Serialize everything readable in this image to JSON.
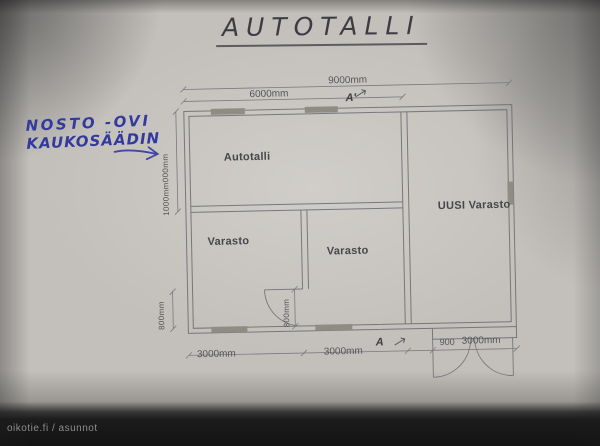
{
  "photo": {
    "title": "AUTOTALLI",
    "watermark": "oikotie.fi / asunnot"
  },
  "note": {
    "line1": "NOSTO -OVI",
    "line2": "KAUKOSÄÄDIN"
  },
  "plan": {
    "rooms": [
      {
        "name": "Autotalli"
      },
      {
        "name": "Varasto"
      },
      {
        "name": "Varasto"
      },
      {
        "name": "UUSI Varasto"
      }
    ],
    "dims": {
      "top_total": "9000mm",
      "top_inner": "6000mm",
      "left_vertical": "1000mm000mm",
      "bottom_left": "3000mm",
      "bottom_mid": "3000mm",
      "bottom_right_small": "900",
      "bottom_right": "3000mm",
      "door_left": "800mm",
      "door_mid": "800mm",
      "section_top": "A'",
      "section_bottom": "A"
    },
    "colors": {
      "wall_line": "#6a6a6e",
      "window_fill": "#8f8c84",
      "ink_blue": "#333a9e",
      "label_text": "#47474b"
    }
  }
}
